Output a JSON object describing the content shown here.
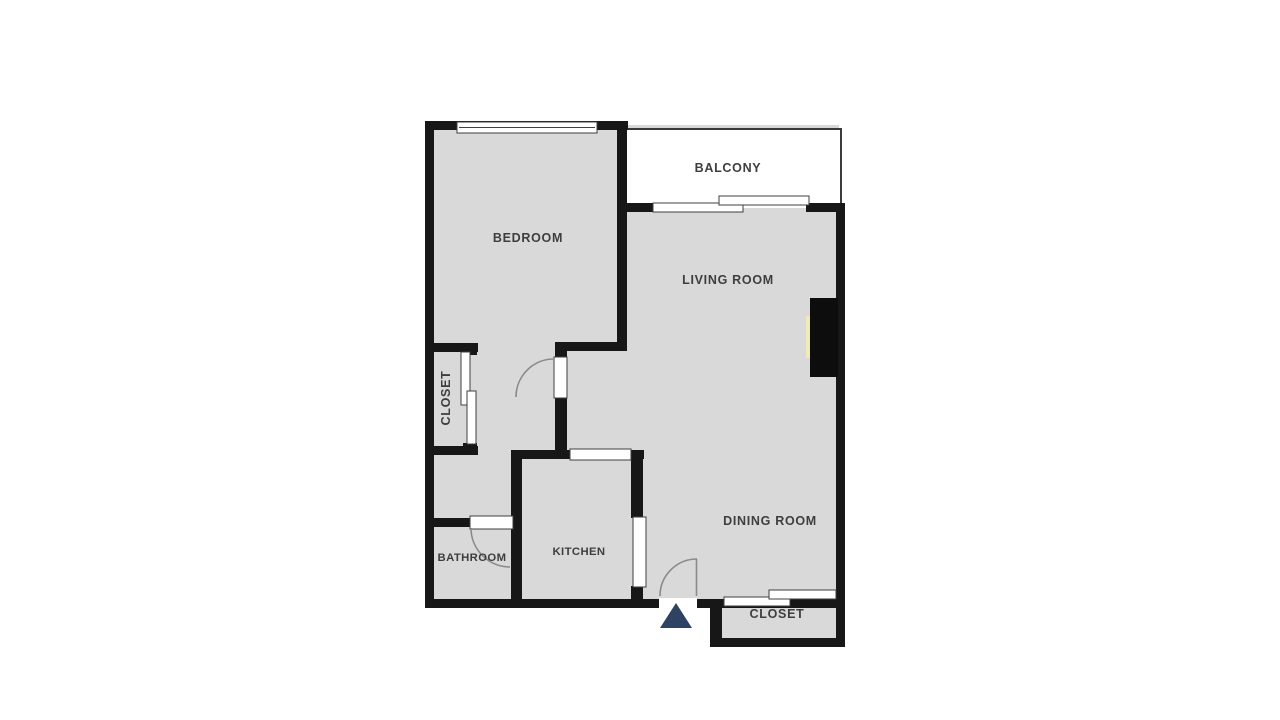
{
  "rooms": {
    "bedroom": {
      "label": "BEDROOM"
    },
    "balcony": {
      "label": "BALCONY"
    },
    "living_room": {
      "label": "LIVING ROOM"
    },
    "closet_hall": {
      "label": "CLOSET"
    },
    "bathroom": {
      "label": "BATHROOM"
    },
    "kitchen": {
      "label": "KITCHEN"
    },
    "dining_room": {
      "label": "DINING ROOM"
    },
    "closet_entry": {
      "label": "CLOSET"
    }
  },
  "icons": {
    "entrance": "entrance-triangle-icon"
  },
  "colors": {
    "background": "#ffffff",
    "wall": "#171717",
    "floor": "#d9d9d9",
    "balcony_floor": "#ffffff",
    "railing": "#3a3a3a",
    "label": "#3e3e3e",
    "entrance_marker": "#2e4263",
    "fireplace": "#0d0d0d",
    "fireplace_accent": "#efeab8",
    "door_arc": "#8a8a8a",
    "opening_border": "#3f3f3f"
  }
}
